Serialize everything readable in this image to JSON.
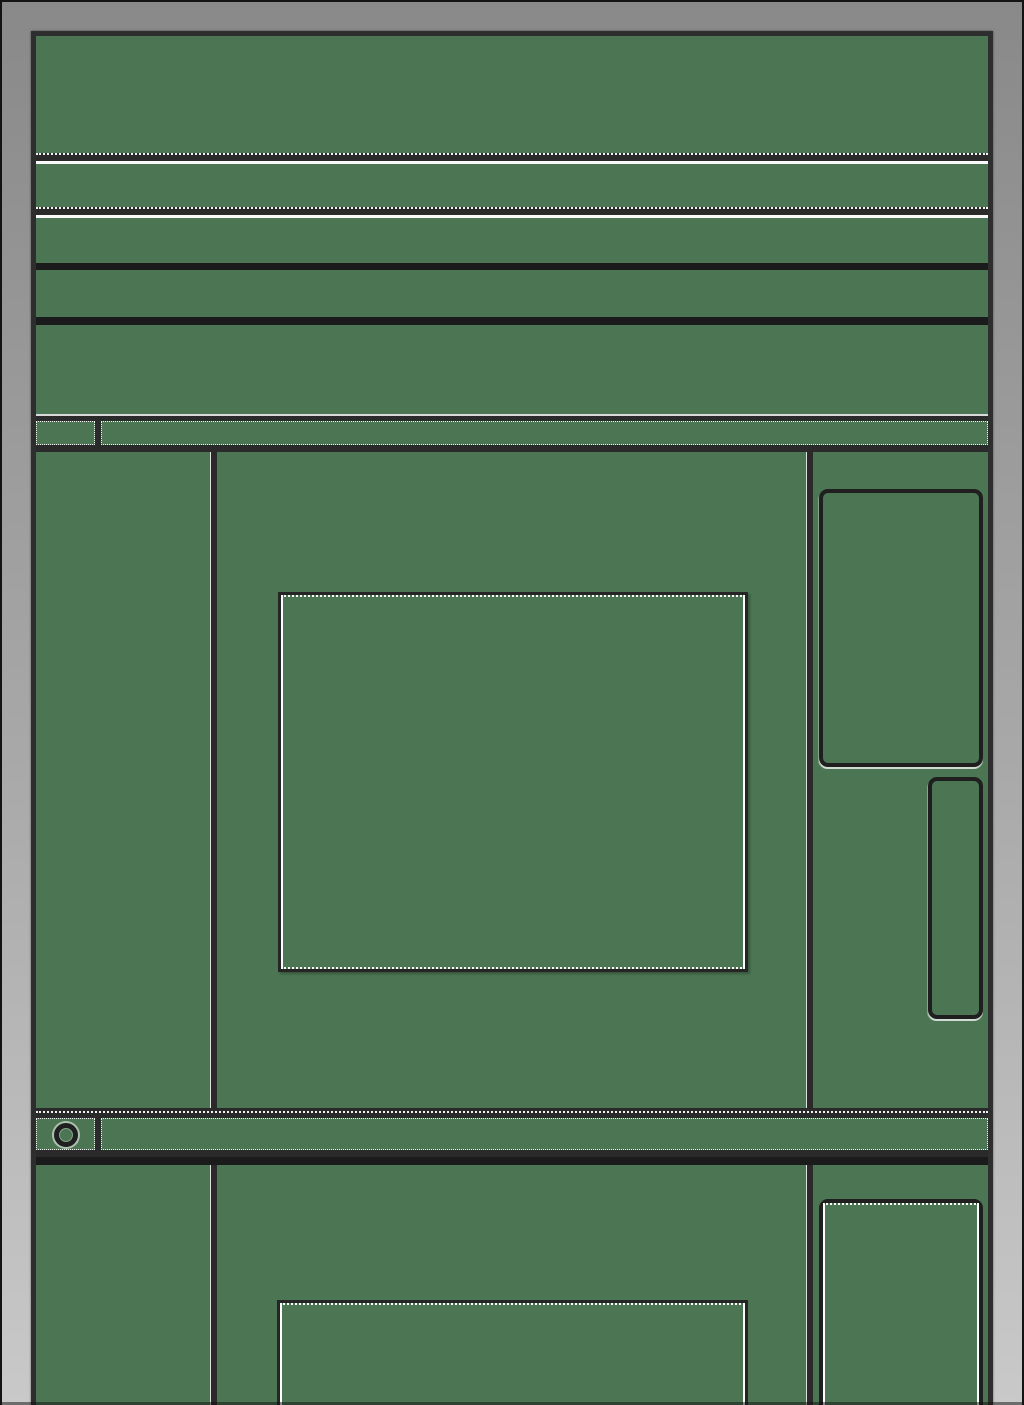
{
  "window": {
    "kind": "wireframe-browser-window",
    "text_content": "none visible"
  },
  "colors": {
    "green": "#4b7553",
    "dark": "#2a2a2a",
    "black": "#1b1b1b",
    "white": "#ffffff",
    "bezel-top": "#898989",
    "bezel-bottom": "#c9c9c9",
    "frame-edge": "#131313",
    "win-border": "#2e2e2e",
    "hl": "#d9d9d9"
  },
  "icons": {
    "status_ring": "css-ring-circle"
  }
}
